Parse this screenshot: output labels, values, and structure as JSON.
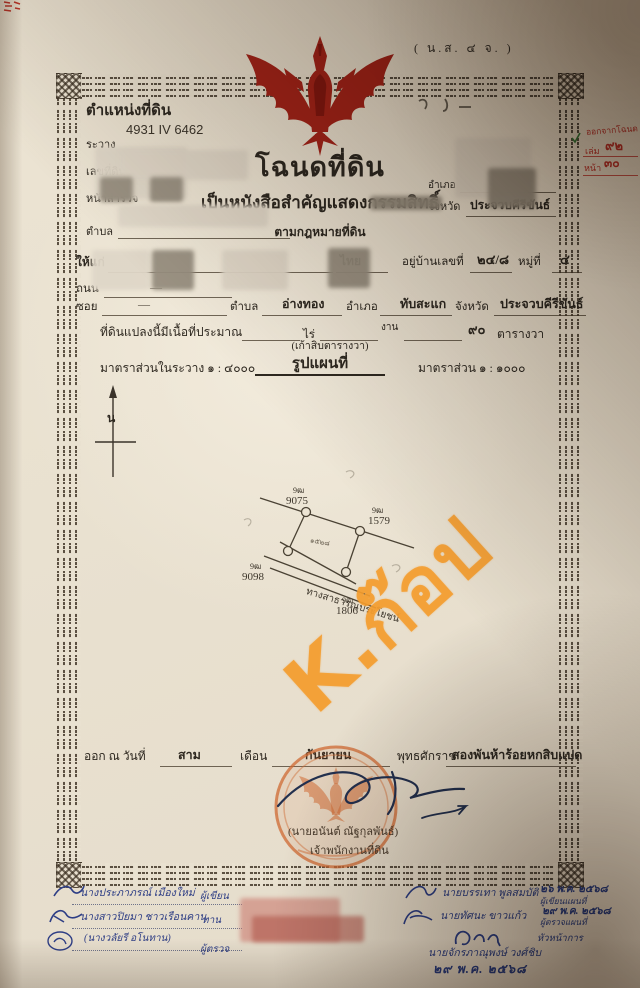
{
  "colors": {
    "garuda_red": "#a62418",
    "ink_blue": "#2e3e85",
    "stamp_orange": "#cf6a33",
    "watermark_orange": "#f49c2c",
    "note_red": "#c03428",
    "paper": "#e9e1d0"
  },
  "corner_note": "( น.ส. ๔ จ. )",
  "header": {
    "position_label": "ตำแหน่งที่ดิน",
    "sheet_no": "4931 IV 6462",
    "rawang_label": "ระวาง",
    "land_no_label": "เลขที่ดิน",
    "survey_label": "หน้าสำรวจ",
    "tambon_label": "ตำบล"
  },
  "title": {
    "main": "โฉนดที่ดิน",
    "sub1": "เป็นหนังสือสำคัญแสดงกรรมสิทธิ์",
    "sub2": "ตามกฎหมายที่ดิน"
  },
  "region": {
    "amphoe_label": "อำเภอ",
    "changwat_label": "จังหวัด",
    "changwat_value": "ประจวบคีรีขันธ์"
  },
  "margin_note": {
    "line1": "ออกจากโฉนด",
    "book_label": "เล่ม",
    "book_value": "๙๒",
    "page_label": "หน้า",
    "page_value": "๓๐"
  },
  "grantee": {
    "label": "ให้แก่",
    "nationality": "ไทย",
    "house_label": "อยู่บ้านเลขที่",
    "house_no": "๒๔/๘",
    "moo_label": "หมู่ที่",
    "moo_no": "๔",
    "road_label": "ถนน",
    "soi_label": "ซอย",
    "tambon_label": "ตำบล",
    "tambon": "อ่างทอง",
    "amphoe_label": "อำเภอ",
    "amphoe": "ทับสะแก",
    "changwat_label": "จังหวัด",
    "changwat": "ประจวบคีรีขันธ์"
  },
  "area": {
    "prefix": "ที่ดินแปลงนี้มีเนื้อที่ประมาณ",
    "rai_label": "ไร่",
    "ngan_label": "งาน",
    "wa_value": "๙๐",
    "wa_label": "ตารางวา",
    "spelled": "(เก้าสิบตารางวา)"
  },
  "map": {
    "scale_left": "มาตราส่วนในระวาง  ๑ : ๔๐๐๐",
    "title": "รูปแผนที่",
    "scale_right": "มาตราส่วน  ๑ : ๑๐๐๐",
    "north": "น",
    "road": "ทางสาธารณประโยชน์",
    "parcel_no": "๑๕๒๘",
    "markers": [
      {
        "prefix": "9ฒ",
        "no": "9075"
      },
      {
        "prefix": "9ฒ",
        "no": "1579"
      },
      {
        "prefix": "9ฒ",
        "no": "9098"
      },
      {
        "prefix": "9ฒ",
        "no": "1806"
      }
    ]
  },
  "watermark": "K.ก๊อป",
  "issue": {
    "prefix": "ออก ณ วันที่",
    "day": "สาม",
    "month_label": "เดือน",
    "month": "กันยายน",
    "era_label": "พุทธศักราช",
    "year": "สองพันห้าร้อยหกสิบแปด"
  },
  "officer": {
    "name": "(นายอนันต์  ณัฐกุลพันธ์)",
    "title": "เจ้าพนักงานที่ดิน"
  },
  "left_officials": {
    "writer_name": "นางประภาภรณ์ เมืองใหม่",
    "writer_role": "ผู้เขียน",
    "checker_name": "นางสาวปิยมา ชาวเรือนคาน",
    "checker_role": "ทาน",
    "examiner_name": "(นางวลัยรี อโนทาน)",
    "examiner_role": "ผู้ตรวจ"
  },
  "right_officials": {
    "map_writer": "นายบรรเทา พูลสมบัติ",
    "map_writer_date": "๒๖ พ.ค. ๒๕๖๘",
    "map_writer_role": "ผู้เขียนแผนที่",
    "map_checker": "นายทัศนะ ขาวแก้ว",
    "map_checker_date": "๒๙ พ.ค. ๒๕๖๘",
    "map_checker_role": "ผู้ตรวจแผนที่",
    "chief_role": "หัวหน้าการ",
    "chief_name": "นายจักรภาณุพงษ์ วงศ์ชิบ",
    "stamp_date": "๒๙ พ.ค. ๒๕๖๘"
  }
}
